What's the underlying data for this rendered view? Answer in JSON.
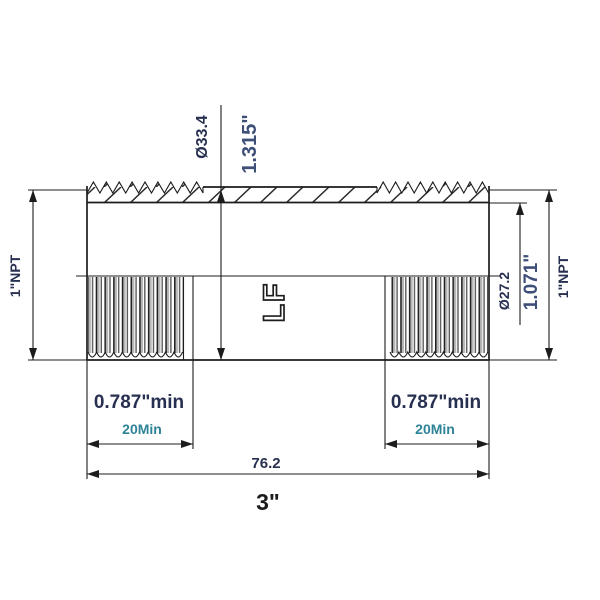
{
  "drawing": {
    "labels": {
      "od_mm": "Ø33.4",
      "od_in": "1.315\"",
      "npt_left": "1\"NPT",
      "npt_right": "1\"NPT",
      "bore_mm": "Ø27.2",
      "bore_in": "1.071\"",
      "thread_min_left": "0.787\"min",
      "thread_min_left_mm": "20Min",
      "thread_min_right": "0.787\"min",
      "thread_min_right_mm": "20Min",
      "overall_mm": "76.2",
      "overall_in": "3\"",
      "part_mark": "LF"
    },
    "colors": {
      "line": "#1c1c1c",
      "dim_text": "#273050",
      "dim_text_large": "#3d4e77",
      "teal_text": "#2f8398",
      "thread_shade": "#b8b8b8",
      "background": "#ffffff"
    }
  }
}
